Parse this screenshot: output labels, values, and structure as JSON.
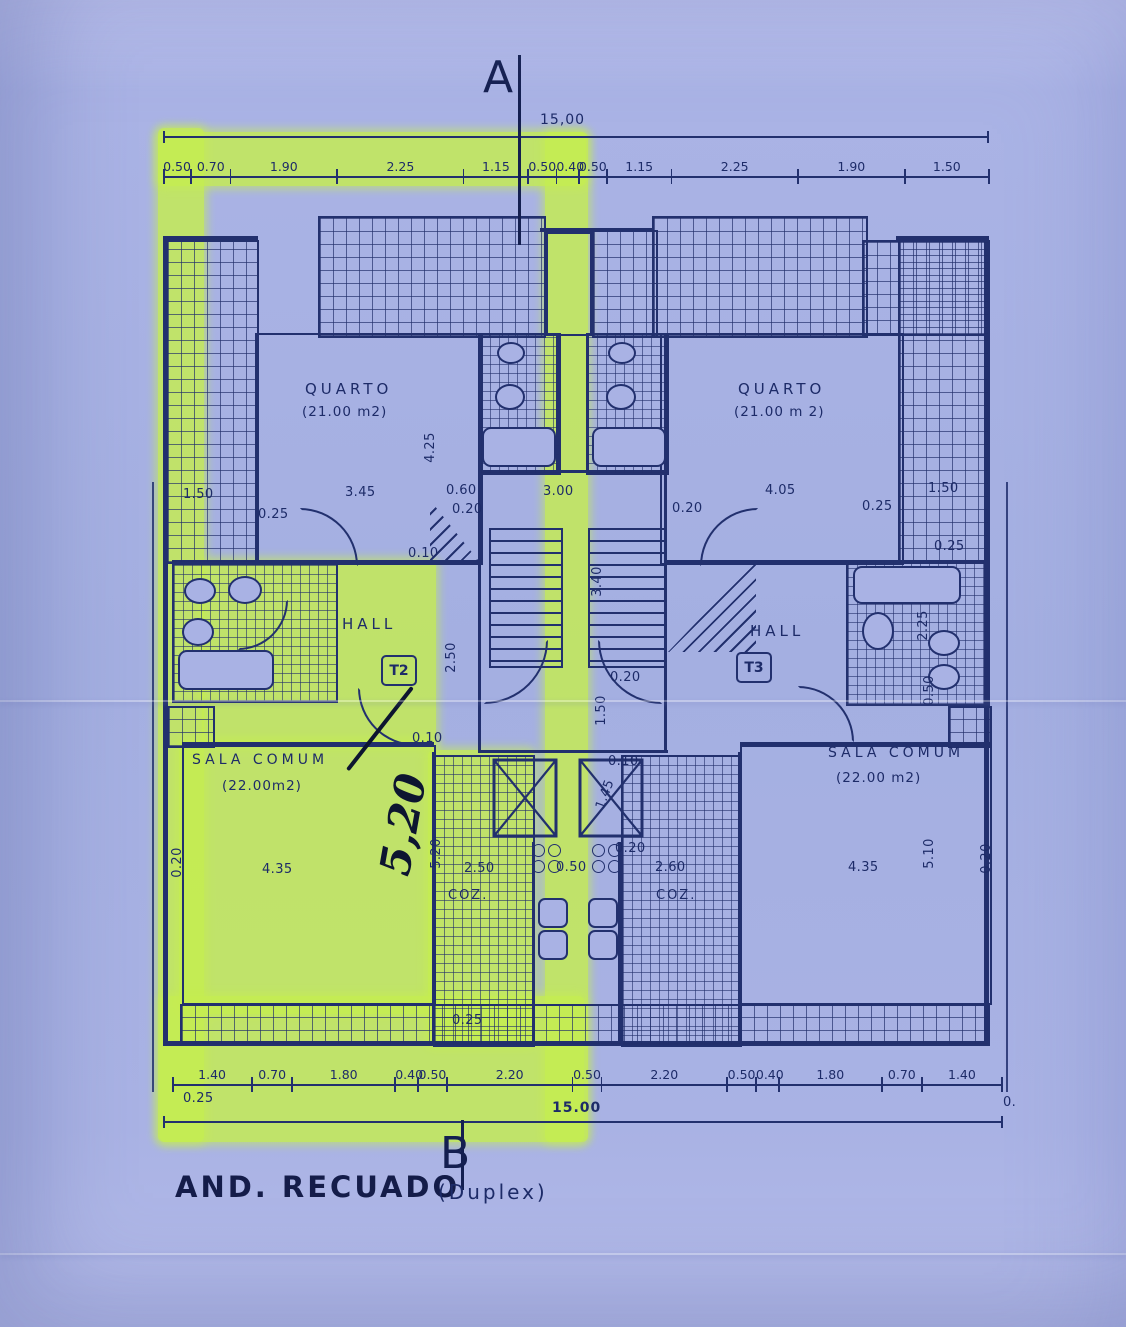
{
  "page": {
    "section_marker_top": "A",
    "section_marker_bottom": "B",
    "title": "AND. RECUADO",
    "title_suffix": "(Duplex)"
  },
  "dims_top": {
    "total": "15,00",
    "segments": [
      {
        "label": "0.50",
        "w": 0.5
      },
      {
        "label": "0.70",
        "w": 0.7
      },
      {
        "label": "1.90",
        "w": 1.9
      },
      {
        "label": "2.25",
        "w": 2.25
      },
      {
        "label": "1.15",
        "w": 1.15
      },
      {
        "label": "0.50",
        "w": 0.5
      },
      {
        "label": "0.40",
        "w": 0.4
      },
      {
        "label": "0.50",
        "w": 0.5
      },
      {
        "label": "1.15",
        "w": 1.15
      },
      {
        "label": "2.25",
        "w": 2.25
      },
      {
        "label": "1.90",
        "w": 1.9
      },
      {
        "label": "1.50",
        "w": 1.5
      }
    ]
  },
  "dims_bottom": {
    "total": "15.00",
    "left_offset": "0.25",
    "right_offset": "0.",
    "segments": [
      {
        "label": "1.40",
        "w": 1.4
      },
      {
        "label": "0.70",
        "w": 0.7
      },
      {
        "label": "1.80",
        "w": 1.8
      },
      {
        "label": "0.40",
        "w": 0.4
      },
      {
        "label": "0.50",
        "w": 0.5
      },
      {
        "label": "2.20",
        "w": 2.2
      },
      {
        "label": "0.50",
        "w": 0.5
      },
      {
        "label": "2.20",
        "w": 2.2
      },
      {
        "label": "0.50",
        "w": 0.5
      },
      {
        "label": "0.40",
        "w": 0.4
      },
      {
        "label": "1.80",
        "w": 1.8
      },
      {
        "label": "0.70",
        "w": 0.7
      },
      {
        "label": "1.40",
        "w": 1.4
      }
    ]
  },
  "rooms": {
    "quarto_left": {
      "name": "QUARTO",
      "area": "(21.00 m2)"
    },
    "quarto_right": {
      "name": "QUARTO",
      "area": "(21.00 m 2)"
    },
    "hall_left": {
      "name": "HALL",
      "tag": "T2"
    },
    "hall_right": {
      "name": "HALL",
      "tag": "T3"
    },
    "sala_left": {
      "name": "SALA COMUM",
      "area": "(22.00m2)"
    },
    "sala_right": {
      "name": "SALA COMUM",
      "area": "(22.00 m2)"
    },
    "coz_left": {
      "name": "COZ."
    },
    "coz_right": {
      "name": "COZ."
    }
  },
  "handwritten": {
    "text": "5,20"
  },
  "annotations": [
    {
      "t": "1.50",
      "x": 183,
      "y": 487
    },
    {
      "t": "0.25",
      "x": 258,
      "y": 507
    },
    {
      "t": "3.45",
      "x": 345,
      "y": 485
    },
    {
      "t": "0.60",
      "x": 446,
      "y": 483
    },
    {
      "t": "0.20",
      "x": 452,
      "y": 502
    },
    {
      "t": "3.00",
      "x": 543,
      "y": 484
    },
    {
      "t": "0.20",
      "x": 672,
      "y": 501
    },
    {
      "t": "4.05",
      "x": 765,
      "y": 483
    },
    {
      "t": "0.25",
      "x": 862,
      "y": 499
    },
    {
      "t": "1.50",
      "x": 928,
      "y": 481
    },
    {
      "t": "0.25",
      "x": 934,
      "y": 539
    },
    {
      "t": "0.10",
      "x": 408,
      "y": 546
    },
    {
      "t": "4.25",
      "x": 415,
      "y": 440,
      "r": -90
    },
    {
      "t": "3.40",
      "x": 582,
      "y": 574,
      "r": -90
    },
    {
      "t": "2.50",
      "x": 436,
      "y": 650,
      "r": -90
    },
    {
      "t": "2.25",
      "x": 908,
      "y": 618,
      "r": -90
    },
    {
      "t": "1.50",
      "x": 586,
      "y": 703,
      "r": -90
    },
    {
      "t": "0.50",
      "x": 914,
      "y": 683,
      "r": -90
    },
    {
      "t": "0.20",
      "x": 610,
      "y": 670
    },
    {
      "t": "0.10",
      "x": 412,
      "y": 731
    },
    {
      "t": "0.10",
      "x": 608,
      "y": 754
    },
    {
      "t": "1.45",
      "x": 590,
      "y": 787,
      "r": -70
    },
    {
      "t": "5.20",
      "x": 421,
      "y": 846,
      "r": -90
    },
    {
      "t": "0.20",
      "x": 162,
      "y": 855,
      "r": -90
    },
    {
      "t": "4.35",
      "x": 262,
      "y": 862
    },
    {
      "t": "2.50",
      "x": 464,
      "y": 861
    },
    {
      "t": "0.50",
      "x": 556,
      "y": 860
    },
    {
      "t": "0.20",
      "x": 615,
      "y": 841
    },
    {
      "t": "2.60",
      "x": 655,
      "y": 860
    },
    {
      "t": "4.35",
      "x": 848,
      "y": 860
    },
    {
      "t": "5.10",
      "x": 914,
      "y": 846,
      "r": -90
    },
    {
      "t": "0.20",
      "x": 971,
      "y": 851,
      "r": -90
    },
    {
      "t": "0.25",
      "x": 452,
      "y": 1013
    },
    {
      "t": "0.25",
      "x": 183,
      "y": 1091
    },
    {
      "t": "0.",
      "x": 1003,
      "y": 1095
    }
  ]
}
